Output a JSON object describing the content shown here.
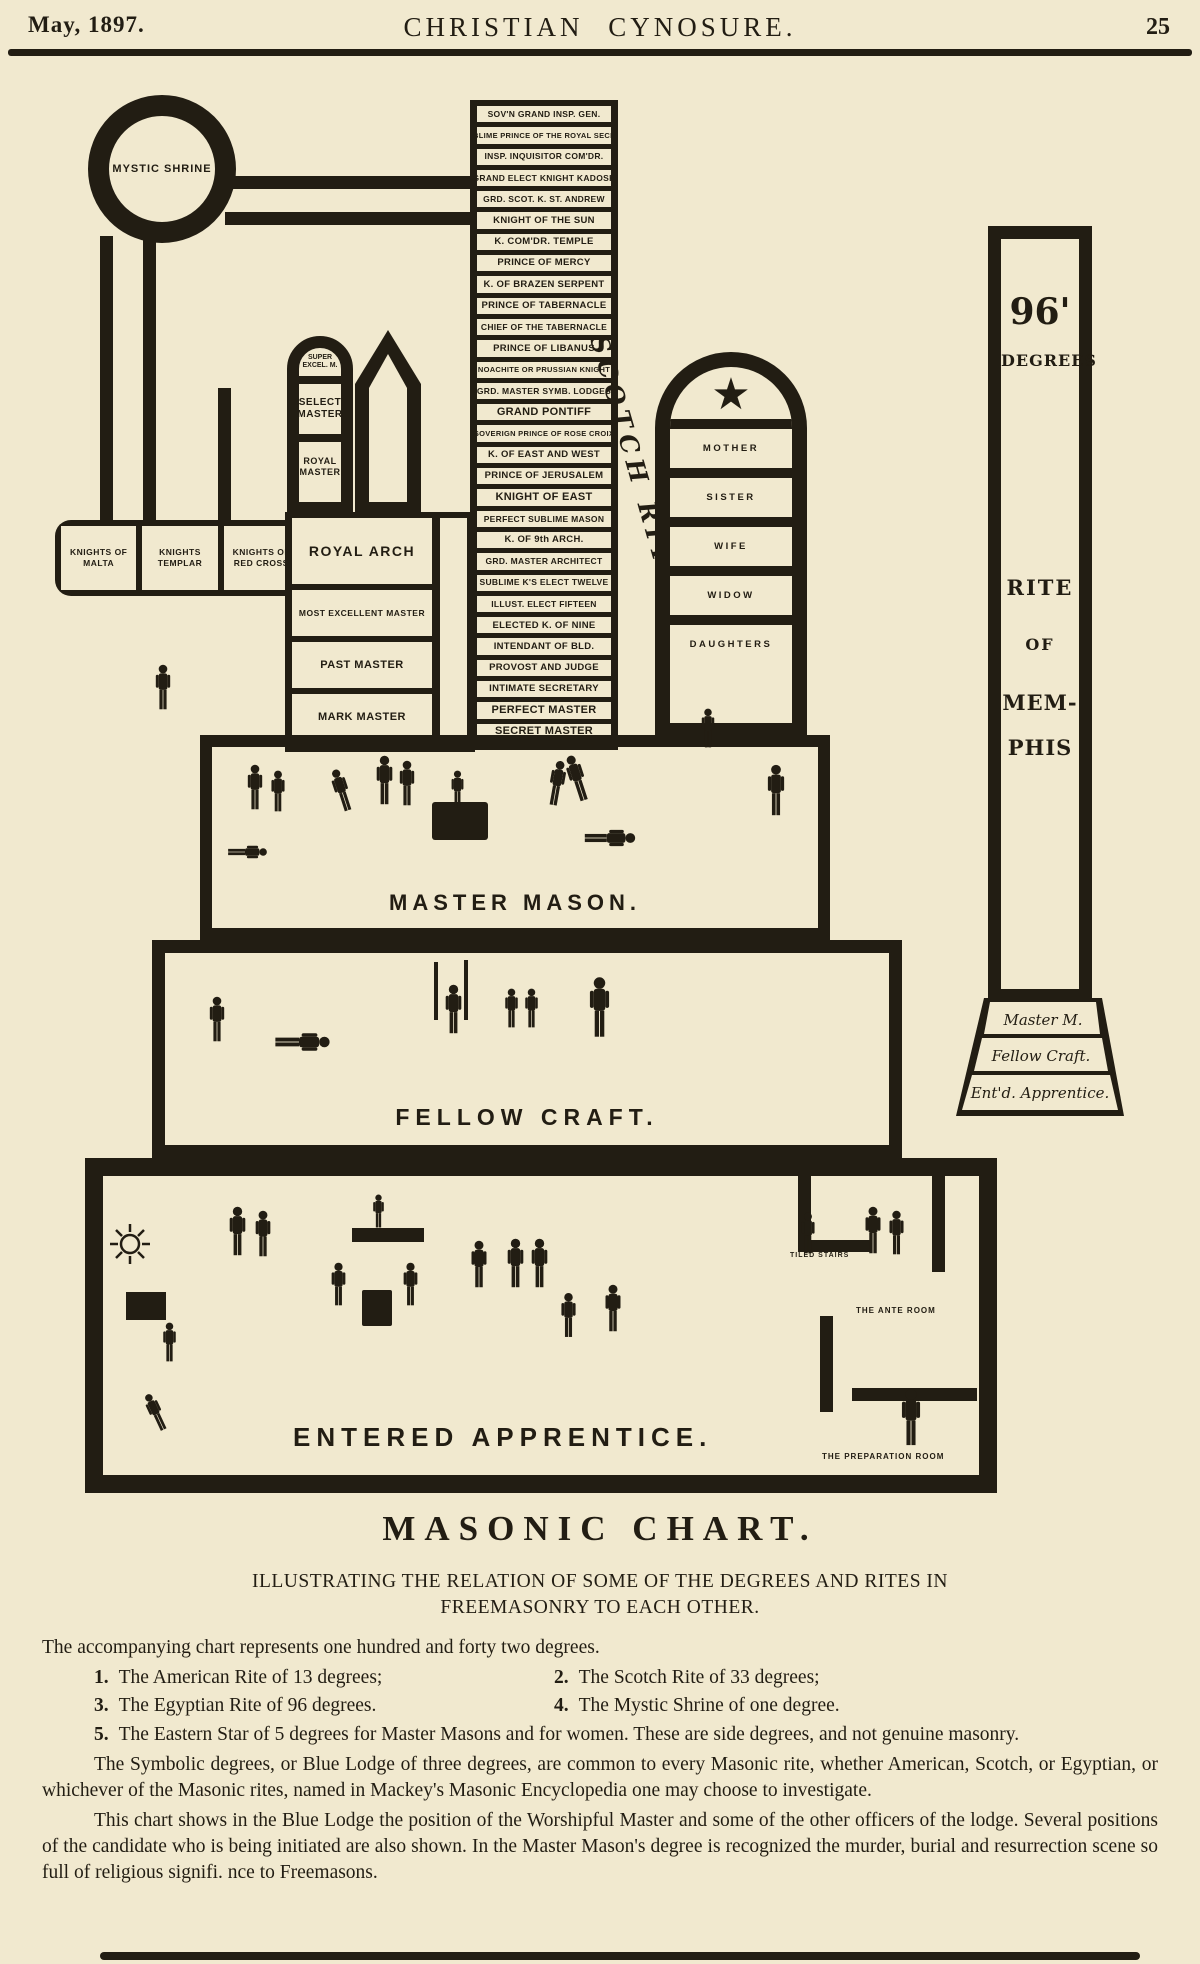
{
  "header": {
    "date": "May, 1897.",
    "title": "CHRISTIAN CYNOSURE.",
    "page_number": "25"
  },
  "chart": {
    "mystic_shrine_label": "MYSTIC SHRINE",
    "scotch_rite_label": "SCOTCH RITE",
    "scotch_rite_degrees": [
      "SOV'N GRAND INSP. GEN.",
      "SUBLIME PRINCE OF THE ROYAL SECRET",
      "INSP. INQUISITOR COM'DR.",
      "GRAND ELECT KNIGHT KADOSH",
      "GRD. SCOT. K. ST. ANDREW",
      "KNIGHT OF THE SUN",
      "K. COM'DR. TEMPLE",
      "PRINCE OF MERCY",
      "K. OF BRAZEN SERPENT",
      "PRINCE OF TABERNACLE",
      "CHIEF OF THE TABERNACLE",
      "PRINCE OF LIBANUS",
      "NOACHITE OR PRUSSIAN KNIGHT",
      "GRD. MASTER SYMB. LODGES",
      "GRAND PONTIFF",
      "SOVERIGN PRINCE OF ROSE CROIX",
      "K. OF EAST AND WEST",
      "PRINCE OF JERUSALEM",
      "KNIGHT OF EAST",
      "PERFECT SUBLIME MASON",
      "K. OF 9th ARCH.",
      "GRD. MASTER ARCHITECT",
      "SUBLIME K'S ELECT TWELVE",
      "ILLUST. ELECT FIFTEEN",
      "ELECTED K. OF NINE",
      "INTENDANT OF BLD.",
      "PROVOST AND JUDGE",
      "INTIMATE SECRETARY",
      "PERFECT MASTER",
      "SECRET MASTER"
    ],
    "american_rite": {
      "arch_cells": [
        "SUPER EXCEL. M.",
        "SELECT MASTER",
        "ROYAL MASTER"
      ],
      "knights": [
        "KNIGHTS OF MALTA",
        "KNIGHTS TEMPLAR",
        "KNIGHTS OF RED CROSS"
      ],
      "royal_arch": "ROYAL ARCH",
      "lower": [
        "MOST EXCELLENT MASTER",
        "PAST MASTER",
        "MARK MASTER"
      ]
    },
    "eastern_star": {
      "star_icon": "★",
      "cells": [
        "MOTHER",
        "SISTER",
        "WIFE",
        "WIDOW",
        "DAUGHTERS"
      ]
    },
    "memphis": {
      "line1": "96'",
      "line2": "DEGREES",
      "line3": "RITE",
      "line4": "OF",
      "line5": "MEM-",
      "line6": "PHIS",
      "base_steps": [
        "Master M.",
        "Fellow Craft.",
        "Ent'd. Apprentice."
      ]
    },
    "levels": {
      "master_mason": "MASTER MASON.",
      "fellow_craft": "FELLOW CRAFT.",
      "entered_apprentice": "ENTERED APPRENTICE."
    },
    "rooms": [
      "TILED STAIRS",
      "THE ANTE ROOM",
      "THE PREPARATION ROOM"
    ]
  },
  "caption": {
    "title": "MASONIC CHART.",
    "subtitle_line1": "ILLUSTRATING THE RELATION OF SOME OF THE DEGREES AND RITES IN",
    "subtitle_line2": "FREEMASONRY TO EACH OTHER.",
    "intro": "The accompanying chart represents one hundred and forty two degrees.",
    "items": [
      {
        "num": "1.",
        "text": "The American Rite of 13 degrees;"
      },
      {
        "num": "2.",
        "text": "The Scotch Rite of 33 degrees;"
      },
      {
        "num": "3.",
        "text": "The Egyptian Rite of 96 degrees."
      },
      {
        "num": "4.",
        "text": "The Mystic Shrine of one degree."
      },
      {
        "num": "5.",
        "text": "The Eastern Star of 5 degrees for Master Masons and for women.  These are side degrees, and not genuine masonry."
      }
    ],
    "para1": "The Symbolic degrees, or Blue Lodge of three degrees, are common to every Masonic rite, whether American, Scotch, or Egyptian, or whichever of the Masonic rites, named in Mackey's Masonic Encyclopedia one may choose to investigate.",
    "para2": "This chart shows in the Blue Lodge the position of the Worshipful Master and some of the other officers of the lodge.  Several positions of the candidate who is being initiated are also shown.  In the Master Mason's degree is recognized the murder, burial and resurrection scene so full of religious signifi. nce to Freemasons."
  },
  "colors": {
    "paper": "#f1e9cf",
    "ink": "#221d13"
  }
}
